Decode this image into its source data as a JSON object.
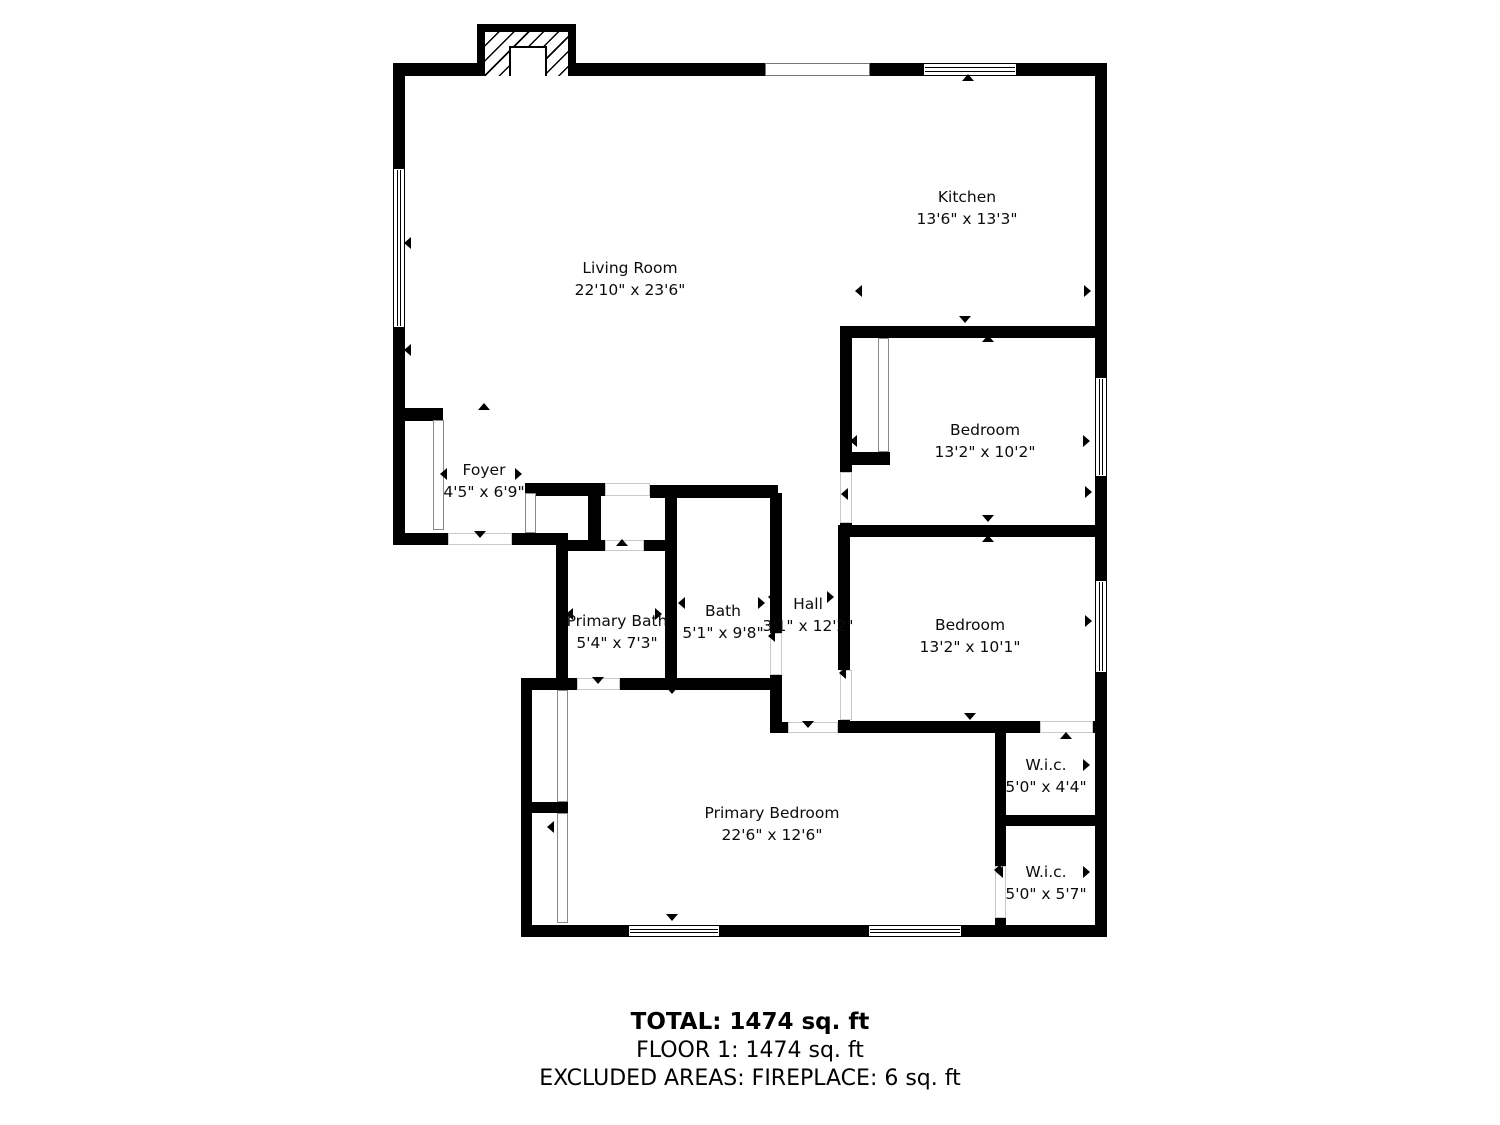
{
  "title": "Floor plan",
  "colors": {
    "wall": "#000000",
    "background": "#ffffff",
    "door_outline": "#c9c9c9"
  },
  "summary": {
    "total": "TOTAL: 1474 sq. ft",
    "floor": "FLOOR 1: 1474 sq. ft",
    "excluded": "EXCLUDED AREAS: FIREPLACE: 6 sq. ft"
  },
  "floorplan": {
    "rooms": [
      {
        "name": "Living Room",
        "dims": "22'10\" x 23'6\"",
        "cx": 630,
        "cy": 268
      },
      {
        "name": "Kitchen",
        "dims": "13'6\" x 13'3\"",
        "cx": 967,
        "cy": 197
      },
      {
        "name": "Bedroom",
        "dims": "13'2\" x 10'2\"",
        "cx": 985,
        "cy": 430
      },
      {
        "name": "Bedroom",
        "dims": "13'2\" x 10'1\"",
        "cx": 970,
        "cy": 625
      },
      {
        "name": "Foyer",
        "dims": "4'5\" x 6'9\"",
        "cx": 484,
        "cy": 470
      },
      {
        "name": "Primary Bath",
        "dims": "5'4\" x 7'3\"",
        "cx": 617,
        "cy": 621
      },
      {
        "name": "Bath",
        "dims": "5'1\" x 9'8\"",
        "cx": 723,
        "cy": 611
      },
      {
        "name": "Hall",
        "dims": "3'1\" x 12'2\"",
        "cx": 808,
        "cy": 604
      },
      {
        "name": "Primary Bedroom",
        "dims": "22'6\" x 12'6\"",
        "cx": 772,
        "cy": 813
      },
      {
        "name": "W.i.c.",
        "dims": "5'0\" x 4'4\"",
        "cx": 1046,
        "cy": 765
      },
      {
        "name": "W.i.c.",
        "dims": "5'0\" x 5'7\"",
        "cx": 1046,
        "cy": 872
      }
    ],
    "walls": [
      [
        393,
        63,
        85,
        13
      ],
      [
        575,
        63,
        190,
        13
      ],
      [
        870,
        63,
        53,
        13
      ],
      [
        1017,
        63,
        90,
        13
      ],
      [
        393,
        63,
        12,
        105
      ],
      [
        393,
        328,
        12,
        217
      ],
      [
        393,
        408,
        50,
        13
      ],
      [
        393,
        533,
        55,
        12
      ],
      [
        512,
        533,
        56,
        12
      ],
      [
        525,
        483,
        80,
        13
      ],
      [
        588,
        483,
        13,
        60
      ],
      [
        525,
        531,
        11,
        14
      ],
      [
        556,
        540,
        49,
        11
      ],
      [
        644,
        540,
        33,
        11
      ],
      [
        650,
        485,
        128,
        13
      ],
      [
        665,
        485,
        12,
        205
      ],
      [
        770,
        493,
        12,
        140
      ],
      [
        770,
        675,
        12,
        58
      ],
      [
        556,
        545,
        12,
        145
      ],
      [
        521,
        678,
        56,
        12
      ],
      [
        620,
        678,
        160,
        12
      ],
      [
        521,
        678,
        11,
        259
      ],
      [
        527,
        802,
        41,
        11
      ],
      [
        521,
        925,
        108,
        12
      ],
      [
        719,
        925,
        150,
        12
      ],
      [
        961,
        925,
        146,
        12
      ],
      [
        1095,
        63,
        12,
        314
      ],
      [
        1095,
        477,
        12,
        103
      ],
      [
        1095,
        673,
        12,
        264
      ],
      [
        840,
        326,
        267,
        12
      ],
      [
        840,
        326,
        12,
        146
      ],
      [
        840,
        523,
        12,
        14
      ],
      [
        852,
        452,
        38,
        13
      ],
      [
        838,
        525,
        269,
        12
      ],
      [
        838,
        537,
        12,
        133
      ],
      [
        838,
        720,
        12,
        13
      ],
      [
        838,
        721,
        202,
        12
      ],
      [
        1093,
        721,
        14,
        12
      ],
      [
        772,
        722,
        18,
        11
      ],
      [
        995,
        733,
        11,
        133
      ],
      [
        995,
        815,
        112,
        11
      ],
      [
        995,
        918,
        11,
        8
      ]
    ],
    "windows": [
      {
        "x": 923,
        "y": 63,
        "w": 94,
        "h": 13,
        "o": "h"
      },
      {
        "x": 393,
        "y": 168,
        "w": 12,
        "h": 160,
        "o": "v"
      },
      {
        "x": 1095,
        "y": 377,
        "w": 12,
        "h": 100,
        "o": "v"
      },
      {
        "x": 1095,
        "y": 580,
        "w": 12,
        "h": 93,
        "o": "v"
      },
      {
        "x": 628,
        "y": 925,
        "w": 92,
        "h": 12,
        "o": "h"
      },
      {
        "x": 868,
        "y": 925,
        "w": 94,
        "h": 12,
        "o": "h"
      }
    ],
    "openings": [
      {
        "x": 765,
        "y": 63,
        "w": 105,
        "h": 13
      }
    ],
    "doors": [
      {
        "x": 448,
        "y": 533,
        "w": 64,
        "h": 12
      },
      {
        "x": 605,
        "y": 483,
        "w": 45,
        "h": 13
      },
      {
        "x": 605,
        "y": 540,
        "w": 39,
        "h": 11
      },
      {
        "x": 577,
        "y": 678,
        "w": 43,
        "h": 12
      },
      {
        "x": 788,
        "y": 722,
        "w": 50,
        "h": 11
      },
      {
        "x": 840,
        "y": 472,
        "w": 12,
        "h": 51
      },
      {
        "x": 840,
        "y": 670,
        "w": 12,
        "h": 50
      },
      {
        "x": 770,
        "y": 633,
        "w": 12,
        "h": 42
      },
      {
        "x": 1040,
        "y": 721,
        "w": 53,
        "h": 12
      },
      {
        "x": 995,
        "y": 866,
        "w": 11,
        "h": 52
      }
    ],
    "sliders": [
      {
        "x": 433,
        "y": 420,
        "w": 11,
        "h": 110
      },
      {
        "x": 525,
        "y": 493,
        "w": 11,
        "h": 40
      },
      {
        "x": 878,
        "y": 338,
        "w": 11,
        "h": 114
      },
      {
        "x": 557,
        "y": 690,
        "w": 11,
        "h": 112
      },
      {
        "x": 557,
        "y": 813,
        "w": 11,
        "h": 110
      }
    ],
    "markers": [
      {
        "x": 480,
        "y": 537,
        "dir": "down",
        "type": "door-marker"
      },
      {
        "x": 484,
        "y": 409,
        "dir": "up",
        "type": "door-marker"
      },
      {
        "x": 968,
        "y": 80,
        "dir": "up",
        "type": "window-marker"
      },
      {
        "x": 622,
        "y": 545,
        "dir": "up",
        "type": "door-marker"
      },
      {
        "x": 598,
        "y": 683,
        "dir": "down",
        "type": "door-marker"
      },
      {
        "x": 672,
        "y": 693,
        "dir": "down",
        "type": "door-marker"
      },
      {
        "x": 808,
        "y": 727,
        "dir": "down",
        "type": "door-marker"
      },
      {
        "x": 847,
        "y": 494,
        "dir": "left",
        "type": "door-marker"
      },
      {
        "x": 845,
        "y": 673,
        "dir": "left",
        "type": "door-marker"
      },
      {
        "x": 774,
        "y": 636,
        "dir": "left",
        "type": "door-marker"
      },
      {
        "x": 1066,
        "y": 738,
        "dir": "up",
        "type": "door-marker"
      },
      {
        "x": 1000,
        "y": 870,
        "dir": "left",
        "type": "door-marker"
      },
      {
        "x": 672,
        "y": 920,
        "dir": "down",
        "type": "window-marker"
      },
      {
        "x": 410,
        "y": 243,
        "dir": "left",
        "type": "window-marker"
      },
      {
        "x": 1091,
        "y": 492,
        "dir": "right",
        "type": "window-marker"
      },
      {
        "x": 1091,
        "y": 621,
        "dir": "right",
        "type": "window-marker"
      },
      {
        "x": 446,
        "y": 474,
        "dir": "left",
        "type": "dimension-arrow"
      },
      {
        "x": 521,
        "y": 474,
        "dir": "right",
        "type": "dimension-arrow"
      },
      {
        "x": 861,
        "y": 291,
        "dir": "left",
        "type": "dimension-arrow"
      },
      {
        "x": 1090,
        "y": 291,
        "dir": "right",
        "type": "dimension-arrow"
      },
      {
        "x": 572,
        "y": 614,
        "dir": "left",
        "type": "dimension-arrow"
      },
      {
        "x": 661,
        "y": 614,
        "dir": "right",
        "type": "dimension-arrow"
      },
      {
        "x": 684,
        "y": 603,
        "dir": "left",
        "type": "dimension-arrow"
      },
      {
        "x": 764,
        "y": 603,
        "dir": "right",
        "type": "dimension-arrow"
      },
      {
        "x": 774,
        "y": 597,
        "dir": "left",
        "type": "dimension-arrow"
      },
      {
        "x": 833,
        "y": 597,
        "dir": "right",
        "type": "dimension-arrow"
      },
      {
        "x": 1002,
        "y": 765,
        "dir": "left",
        "type": "dimension-arrow"
      },
      {
        "x": 1089,
        "y": 765,
        "dir": "right",
        "type": "dimension-arrow"
      },
      {
        "x": 1002,
        "y": 872,
        "dir": "left",
        "type": "dimension-arrow"
      },
      {
        "x": 1089,
        "y": 872,
        "dir": "right",
        "type": "dimension-arrow"
      },
      {
        "x": 553,
        "y": 827,
        "dir": "left",
        "type": "dimension-arrow"
      },
      {
        "x": 410,
        "y": 350,
        "dir": "left",
        "type": "dimension-arrow"
      },
      {
        "x": 856,
        "y": 441,
        "dir": "left",
        "type": "dimension-arrow"
      },
      {
        "x": 1089,
        "y": 441,
        "dir": "right",
        "type": "dimension-arrow"
      },
      {
        "x": 988,
        "y": 521,
        "dir": "down",
        "type": "dimension-arrow"
      },
      {
        "x": 988,
        "y": 341,
        "dir": "up",
        "type": "dimension-arrow"
      },
      {
        "x": 970,
        "y": 719,
        "dir": "down",
        "type": "dimension-arrow"
      },
      {
        "x": 988,
        "y": 541,
        "dir": "up",
        "type": "dimension-arrow"
      },
      {
        "x": 965,
        "y": 322,
        "dir": "down",
        "type": "dimension-arrow"
      }
    ],
    "fireplace": {
      "outer": [
        477,
        24,
        99,
        52
      ],
      "hatch": [
        485,
        32,
        83,
        44
      ],
      "firebox": [
        509,
        46,
        38,
        30
      ]
    }
  }
}
